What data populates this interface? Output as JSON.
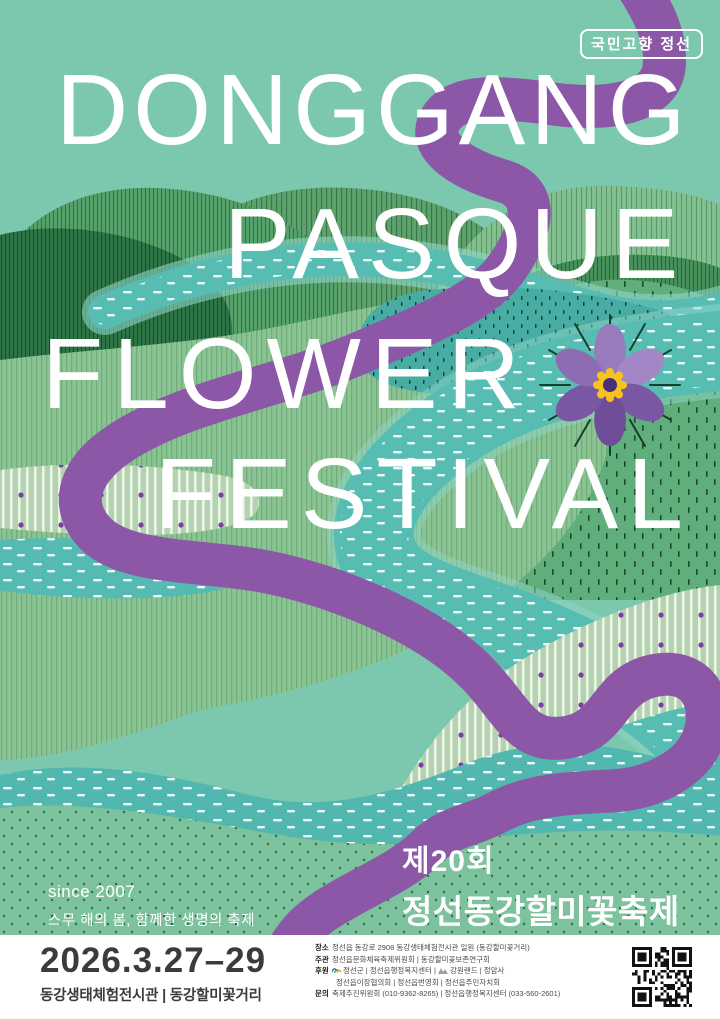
{
  "poster": {
    "badge": "국민고향 정선",
    "headline": [
      "DONGGANG",
      "PASQUE",
      "FLOWER",
      "FESTIVAL"
    ],
    "since": {
      "line1": "since 2007",
      "line2": "스무 해의 봄, 함께한 생명의 축제"
    },
    "title_ko": {
      "line1": "제20회",
      "line2": "정선동강할미꽃축제"
    }
  },
  "footer": {
    "date": "2026.3.27–29",
    "venue": "동강생태체험전시관 | 동강할미꽃거리",
    "info_rows": [
      {
        "label": "장소",
        "text": "정선읍 동강로 2908 동강생태체험전시관 일원 (동강할미꽃거리)"
      },
      {
        "label": "주관",
        "text": "정선읍문화체육축제위원회 | 동강할미꽃보존연구회"
      },
      {
        "label": "후원",
        "seg1": "정선군 | 정선읍행정복지센터 | ",
        "seg2": "강원랜드 | 정암사",
        "line2": "정선읍이장협의회 | 정선읍번영회 | 정선읍주민자치회"
      },
      {
        "label": "문의",
        "text": "축제추진위원회 (010-9362-8265) | 정선읍행정복지센터 (033-560-2601)"
      }
    ]
  },
  "colors": {
    "background_mint": "#7bc8ae",
    "river_teal": "#55b8b0",
    "ribbon_purple": "#8c57a6",
    "flower_petal_dark": "#75519e",
    "flower_petal_light": "#9b7ec4",
    "flower_center_yellow": "#f5c31c",
    "flower_center_core": "#463079",
    "headline_white": "#ffffff",
    "footer_text": "#3b3b3b"
  },
  "icons": {
    "badge_frame": "rounded-outline-box",
    "qr": "qr-code",
    "sponsor_logo_1": "jeongseon-county-logo",
    "sponsor_logo_2": "kangwon-land-logo"
  }
}
